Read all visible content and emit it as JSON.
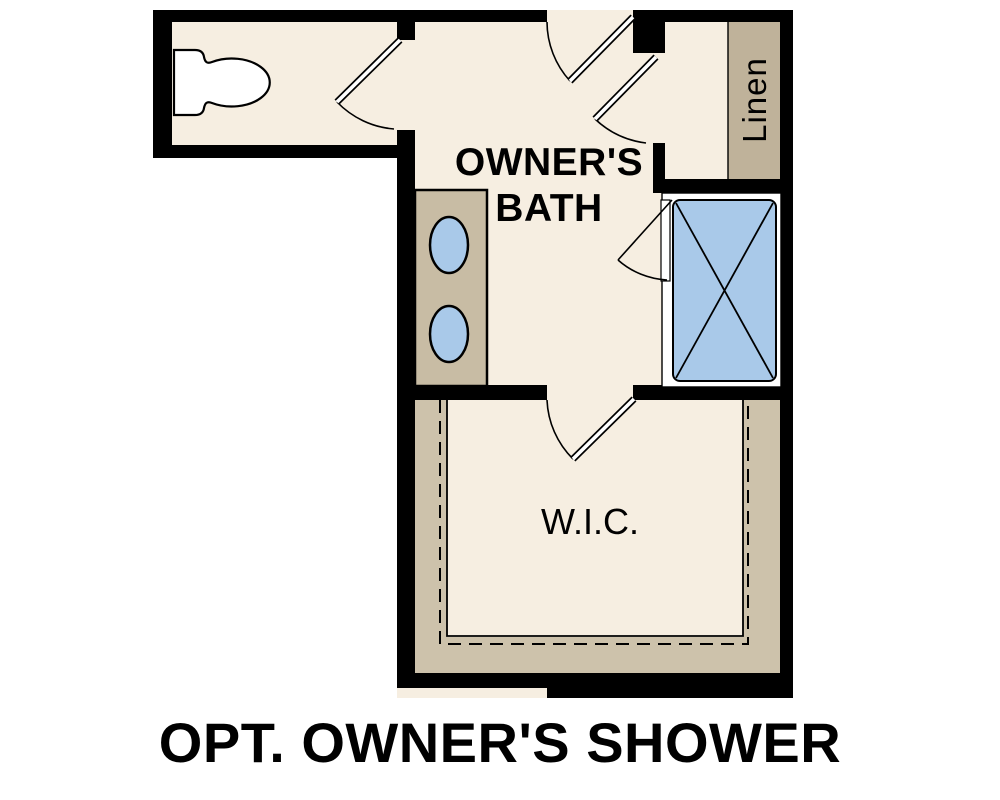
{
  "plan_title": "OPT. OWNER'S SHOWER",
  "rooms": {
    "owners_bath": {
      "label_line1": "OWNER'S",
      "label_line2": "BATH"
    },
    "walk_in_closet": {
      "label": "W.I.C."
    },
    "linen_closet": {
      "label": "Linen"
    }
  },
  "colors": {
    "background": "#ffffff",
    "wall": "#000000",
    "floor": "#f6eee1",
    "linen_shelf": "#bfb29a",
    "vanity": "#c8bca4",
    "wic_shelf": "#cdc2ab",
    "fixture_blue": "#a9c9e9",
    "fixture_white": "#ffffff",
    "outline": "#000000"
  }
}
